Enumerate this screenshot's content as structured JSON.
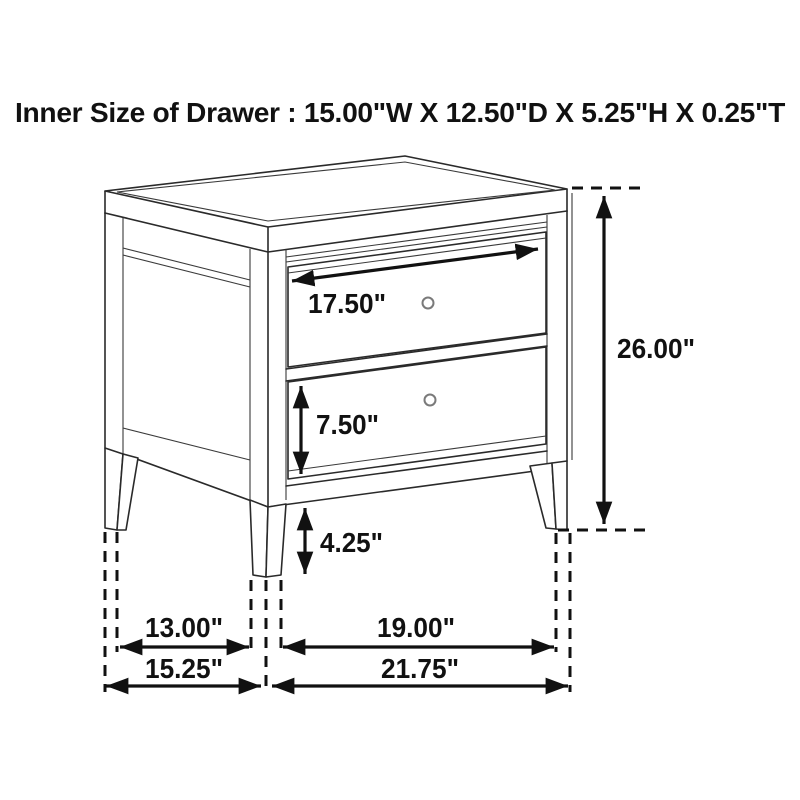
{
  "title": "Inner Size of Drawer : 15.00\"W X 12.50\"D X 5.25\"H X 0.25\"T",
  "inner_drawer_size": {
    "width": "15.00\"W",
    "depth": "12.50\"D",
    "height": "5.25\"H",
    "thickness": "0.25\"T"
  },
  "dimensions": {
    "drawer_front_width": "17.50\"",
    "overall_height": "26.00\"",
    "lower_drawer_height": "7.50\"",
    "floor_clearance": "4.25\"",
    "side_leg_span_inner": "13.00\"",
    "front_leg_span_inner": "19.00\"",
    "overall_depth": "15.25\"",
    "overall_width": "21.75\""
  },
  "colors": {
    "background": "#ffffff",
    "line": "#2a2a2a",
    "dimension": "#111111",
    "knob_stroke": "#7a7a7a"
  }
}
